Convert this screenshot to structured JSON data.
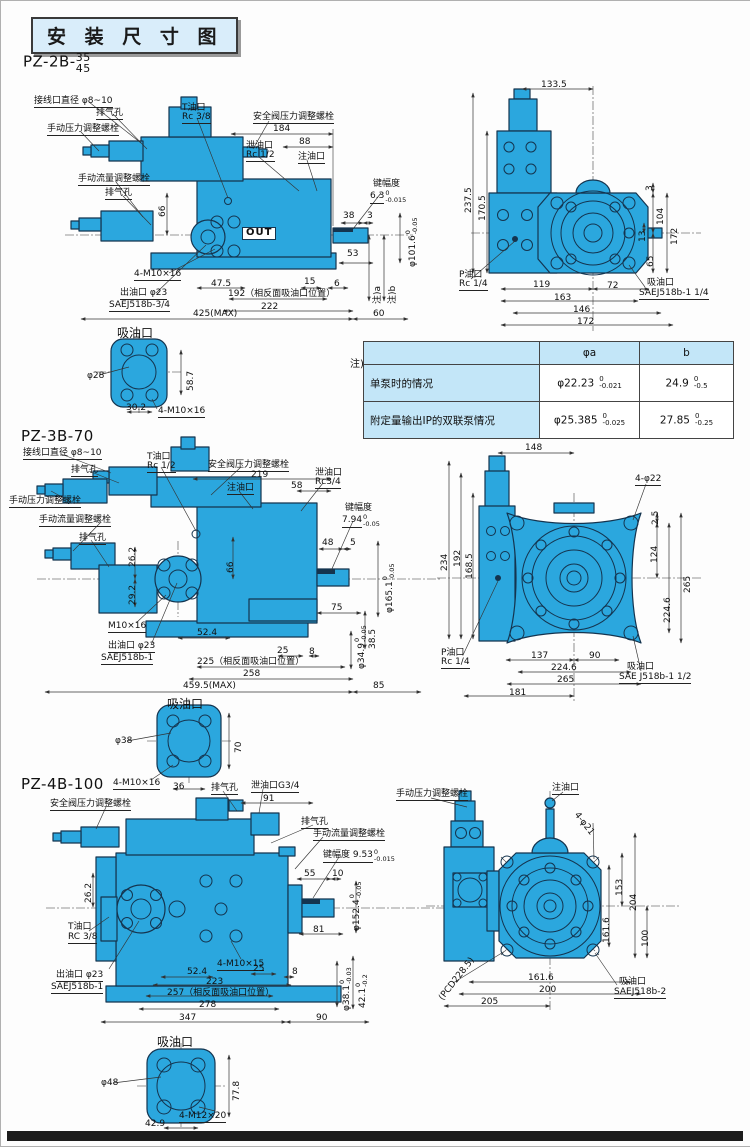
{
  "page": {
    "title": "安 装 尺 寸 图"
  },
  "note_table": {
    "note_label": "注)",
    "col_headers": [
      "φa",
      "b"
    ],
    "rows": [
      {
        "label": "单泵时的情况",
        "a_main": "φ22.23",
        "a_tol_top": "0",
        "a_tol_bot": "-0.021",
        "b_main": "24.9",
        "b_tol_top": "0",
        "b_tol_bot": "-0.5"
      },
      {
        "label": "附定量输出IP的双联泵情况",
        "a_main": "φ25.385",
        "a_tol_top": "0",
        "a_tol_bot": "-0.025",
        "b_main": "27.85",
        "b_tol_top": "0",
        "b_tol_bot": "-0.25"
      }
    ]
  },
  "sections": [
    {
      "name": "pz-2b",
      "model": "PZ-2B-",
      "frac_top": "35",
      "frac_bottom": "45",
      "labels": [
        {
          "t": "接线口直径 φ8~10",
          "x": 33,
          "y": 96,
          "u": 1
        },
        {
          "t": "排气孔",
          "x": 95,
          "y": 108,
          "u": 1
        },
        {
          "t": "T油口",
          "x": 181,
          "y": 103
        },
        {
          "t": "Rc 3/8",
          "x": 181,
          "y": 112,
          "u": 1
        },
        {
          "t": "安全阀压力调整螺栓",
          "x": 252,
          "y": 112,
          "u": 1
        },
        {
          "t": "手动压力调整螺栓",
          "x": 46,
          "y": 124,
          "u": 1
        },
        {
          "t": "184",
          "x": 272,
          "y": 124
        },
        {
          "t": "88",
          "x": 298,
          "y": 137
        },
        {
          "t": "泄油口",
          "x": 245,
          "y": 141
        },
        {
          "t": "Rc 1/2",
          "x": 245,
          "y": 150,
          "u": 1
        },
        {
          "t": "注油口",
          "x": 297,
          "y": 152,
          "u": 1
        },
        {
          "t": "手动流量调整螺栓",
          "x": 77,
          "y": 174,
          "u": 1
        },
        {
          "t": "排气孔",
          "x": 104,
          "y": 188,
          "u": 1
        },
        {
          "t": "66",
          "x": 158,
          "y": 216,
          "r": -90
        },
        {
          "t": "键幅度",
          "x": 372,
          "y": 179
        },
        {
          "t": "6.3",
          "x": 369,
          "y": 189,
          "tt": "0",
          "tb": "-0.015",
          "u": 1
        },
        {
          "t": "38",
          "x": 342,
          "y": 211
        },
        {
          "t": "3",
          "x": 366,
          "y": 211
        },
        {
          "t": "53",
          "x": 346,
          "y": 249
        },
        {
          "t": "φ101.6",
          "x": 404,
          "y": 266,
          "r": -90,
          "tt": "0",
          "tb": "-0.05"
        },
        {
          "t": "6",
          "x": 333,
          "y": 279
        },
        {
          "t": "注)a",
          "x": 373,
          "y": 303,
          "r": -90
        },
        {
          "t": "注)b",
          "x": 388,
          "y": 303,
          "r": -90
        },
        {
          "t": "OUT",
          "x": 241,
          "y": 226,
          "bx": 1
        },
        {
          "t": "4-M10×16",
          "x": 133,
          "y": 269,
          "u": 1
        },
        {
          "t": "47.5",
          "x": 210,
          "y": 279
        },
        {
          "t": "15",
          "x": 303,
          "y": 277
        },
        {
          "t": "出油口 φ23",
          "x": 119,
          "y": 288,
          "u": 1
        },
        {
          "t": "SAEJ518b-3/4",
          "x": 108,
          "y": 300,
          "u": 1
        },
        {
          "t": "192（相反面吸油口位置）",
          "x": 227,
          "y": 289
        },
        {
          "t": "222",
          "x": 260,
          "y": 302
        },
        {
          "t": "425(MAX)",
          "x": 192,
          "y": 309
        },
        {
          "t": "60",
          "x": 372,
          "y": 309
        },
        {
          "t": "133.5",
          "x": 540,
          "y": 80
        },
        {
          "t": "237.5",
          "x": 464,
          "y": 212,
          "r": -90
        },
        {
          "t": "170.5",
          "x": 478,
          "y": 220,
          "r": -90
        },
        {
          "t": "3",
          "x": 645,
          "y": 190,
          "r": -90
        },
        {
          "t": "104",
          "x": 656,
          "y": 224,
          "r": -90
        },
        {
          "t": "13",
          "x": 638,
          "y": 241,
          "r": -90
        },
        {
          "t": "172",
          "x": 670,
          "y": 244,
          "r": -90
        },
        {
          "t": "65",
          "x": 646,
          "y": 266,
          "r": -90
        },
        {
          "t": "P油口",
          "x": 458,
          "y": 270
        },
        {
          "t": "Rc 1/4",
          "x": 458,
          "y": 279,
          "u": 1
        },
        {
          "t": "119",
          "x": 532,
          "y": 280
        },
        {
          "t": "163",
          "x": 553,
          "y": 293
        },
        {
          "t": "72",
          "x": 606,
          "y": 281
        },
        {
          "t": "146",
          "x": 572,
          "y": 305
        },
        {
          "t": "172",
          "x": 576,
          "y": 317
        },
        {
          "t": "吸油口",
          "x": 646,
          "y": 278
        },
        {
          "t": "SAEJ518b-1 1/4",
          "x": 638,
          "y": 288,
          "u": 1
        },
        {
          "t": "吸油口",
          "x": 116,
          "y": 326,
          "fs": 12
        },
        {
          "t": "φ28",
          "x": 86,
          "y": 371
        },
        {
          "t": "58.7",
          "x": 186,
          "y": 390,
          "r": -90
        },
        {
          "t": "30.2",
          "x": 125,
          "y": 403
        },
        {
          "t": "4-M10×16",
          "x": 157,
          "y": 406,
          "u": 1
        }
      ]
    },
    {
      "name": "pz-3b",
      "model": "PZ-3B-70",
      "labels": [
        {
          "t": "接线口直径 φ8~10",
          "x": 22,
          "y": 448,
          "u": 1
        },
        {
          "t": "排气孔",
          "x": 70,
          "y": 465,
          "u": 1
        },
        {
          "t": "T油口",
          "x": 146,
          "y": 452
        },
        {
          "t": "Rc 1/2",
          "x": 146,
          "y": 461,
          "u": 1
        },
        {
          "t": "安全阀压力调整螺栓",
          "x": 207,
          "y": 460,
          "u": 1
        },
        {
          "t": "219",
          "x": 250,
          "y": 470
        },
        {
          "t": "注油口",
          "x": 226,
          "y": 483,
          "u": 1
        },
        {
          "t": "58",
          "x": 290,
          "y": 481
        },
        {
          "t": "泄油口",
          "x": 314,
          "y": 468
        },
        {
          "t": "Rc3/4",
          "x": 314,
          "y": 477,
          "u": 1
        },
        {
          "t": "手动压力调整螺栓",
          "x": 8,
          "y": 496,
          "u": 1
        },
        {
          "t": "手动流量调整螺栓",
          "x": 38,
          "y": 515,
          "u": 1
        },
        {
          "t": "排气孔",
          "x": 78,
          "y": 533,
          "u": 1
        },
        {
          "t": "26.2",
          "x": 128,
          "y": 566,
          "r": -90
        },
        {
          "t": "键幅度",
          "x": 344,
          "y": 503
        },
        {
          "t": "7.94",
          "x": 341,
          "y": 513,
          "tt": "0",
          "tb": "-0.05",
          "u": 1
        },
        {
          "t": "48",
          "x": 321,
          "y": 538
        },
        {
          "t": "5",
          "x": 349,
          "y": 538
        },
        {
          "t": "66",
          "x": 226,
          "y": 572,
          "r": -90
        },
        {
          "t": "29.2",
          "x": 128,
          "y": 604,
          "r": -90
        },
        {
          "t": "φ165.1",
          "x": 381,
          "y": 612,
          "r": -90,
          "tt": "0",
          "tb": "-0.05"
        },
        {
          "t": "75",
          "x": 330,
          "y": 603
        },
        {
          "t": "M10×16",
          "x": 107,
          "y": 621,
          "u": 1
        },
        {
          "t": "52.4",
          "x": 196,
          "y": 628
        },
        {
          "t": "38.5",
          "x": 368,
          "y": 648,
          "r": -90
        },
        {
          "t": "φ34.9",
          "x": 353,
          "y": 668,
          "r": -90,
          "tt": "0",
          "tb": "-0.05"
        },
        {
          "t": "出油口 φ23",
          "x": 107,
          "y": 641,
          "u": 1
        },
        {
          "t": "SAEJ518b-1",
          "x": 100,
          "y": 653,
          "u": 1
        },
        {
          "t": "25",
          "x": 276,
          "y": 646
        },
        {
          "t": "8",
          "x": 308,
          "y": 647
        },
        {
          "t": "225（相反面吸油口位置）",
          "x": 196,
          "y": 657
        },
        {
          "t": "258",
          "x": 242,
          "y": 669
        },
        {
          "t": "459.5(MAX)",
          "x": 182,
          "y": 681
        },
        {
          "t": "85",
          "x": 372,
          "y": 681
        },
        {
          "t": "吸油口",
          "x": 166,
          "y": 697,
          "fs": 12
        },
        {
          "t": "148",
          "x": 524,
          "y": 443
        },
        {
          "t": "4-φ22",
          "x": 634,
          "y": 474,
          "u": 1
        },
        {
          "t": "2.5",
          "x": 651,
          "y": 524,
          "r": -90
        },
        {
          "t": "234",
          "x": 440,
          "y": 570,
          "r": -90
        },
        {
          "t": "192",
          "x": 453,
          "y": 566,
          "r": -90
        },
        {
          "t": "168.5",
          "x": 465,
          "y": 578,
          "r": -90
        },
        {
          "t": "124",
          "x": 650,
          "y": 562,
          "r": -90
        },
        {
          "t": "265",
          "x": 683,
          "y": 592,
          "r": -90
        },
        {
          "t": "224.6",
          "x": 663,
          "y": 622,
          "r": -90
        },
        {
          "t": "P油口",
          "x": 440,
          "y": 648
        },
        {
          "t": "Rc 1/4",
          "x": 440,
          "y": 657,
          "u": 1
        },
        {
          "t": "137",
          "x": 530,
          "y": 651
        },
        {
          "t": "90",
          "x": 588,
          "y": 651
        },
        {
          "t": "224.6",
          "x": 550,
          "y": 663
        },
        {
          "t": "265",
          "x": 556,
          "y": 675
        },
        {
          "t": "181",
          "x": 508,
          "y": 688
        },
        {
          "t": "吸油口",
          "x": 626,
          "y": 662
        },
        {
          "t": "SAE J518b-1 1/2",
          "x": 618,
          "y": 672,
          "u": 1
        },
        {
          "t": "φ38",
          "x": 114,
          "y": 736
        },
        {
          "t": "70",
          "x": 234,
          "y": 752,
          "r": -90
        },
        {
          "t": "4-M10×16",
          "x": 112,
          "y": 778,
          "u": 1
        },
        {
          "t": "36",
          "x": 172,
          "y": 782
        }
      ]
    },
    {
      "name": "pz-4b",
      "model": "PZ-4B-100",
      "labels": [
        {
          "t": "安全阀压力调整螺栓",
          "x": 49,
          "y": 799,
          "u": 1
        },
        {
          "t": "排气孔",
          "x": 210,
          "y": 783,
          "u": 1
        },
        {
          "t": "泄油口G3/4",
          "x": 250,
          "y": 781,
          "u": 1
        },
        {
          "t": "91",
          "x": 262,
          "y": 794
        },
        {
          "t": "排气孔",
          "x": 300,
          "y": 817,
          "u": 1
        },
        {
          "t": "手动压力调整螺栓",
          "x": 395,
          "y": 789,
          "u": 1
        },
        {
          "t": "注油口",
          "x": 551,
          "y": 783,
          "u": 1
        },
        {
          "t": "手动流量调整螺栓",
          "x": 312,
          "y": 829,
          "u": 1
        },
        {
          "t": "键幅度 9.53",
          "x": 322,
          "y": 848,
          "tt": "0",
          "tb": "-0.015",
          "u": 1
        },
        {
          "t": "26.2",
          "x": 84,
          "y": 902,
          "r": -90
        },
        {
          "t": "55",
          "x": 303,
          "y": 869
        },
        {
          "t": "10",
          "x": 331,
          "y": 869
        },
        {
          "t": "4-φ21",
          "x": 578,
          "y": 810,
          "r": 52
        },
        {
          "t": "153",
          "x": 615,
          "y": 895,
          "r": -90
        },
        {
          "t": "204",
          "x": 629,
          "y": 910,
          "r": -90
        },
        {
          "t": "φ152.4",
          "x": 348,
          "y": 930,
          "r": -90,
          "tt": "0",
          "tb": "-0.05"
        },
        {
          "t": "T油口",
          "x": 67,
          "y": 922
        },
        {
          "t": "RC 3/8",
          "x": 67,
          "y": 932,
          "u": 1
        },
        {
          "t": "81",
          "x": 312,
          "y": 925
        },
        {
          "t": "161.6",
          "x": 602,
          "y": 942,
          "r": -90
        },
        {
          "t": "100",
          "x": 641,
          "y": 946,
          "r": -90
        },
        {
          "t": "出油口 φ23",
          "x": 55,
          "y": 970,
          "u": 1
        },
        {
          "t": "SAEJ518b-1",
          "x": 50,
          "y": 982,
          "u": 1
        },
        {
          "t": "4-M10×15",
          "x": 216,
          "y": 959,
          "u": 1
        },
        {
          "t": "52.4",
          "x": 186,
          "y": 967
        },
        {
          "t": "25",
          "x": 252,
          "y": 964
        },
        {
          "t": "8",
          "x": 291,
          "y": 967
        },
        {
          "t": "φ38.1",
          "x": 338,
          "y": 1010,
          "r": -90,
          "tt": "0",
          "tb": "-0.03"
        },
        {
          "t": "42.1",
          "x": 354,
          "y": 1007,
          "r": -90,
          "tt": "0",
          "tb": "-0.2"
        },
        {
          "t": "223",
          "x": 205,
          "y": 977
        },
        {
          "t": "257（相反面吸油口位置）",
          "x": 166,
          "y": 988
        },
        {
          "t": "278",
          "x": 198,
          "y": 1000
        },
        {
          "t": "347",
          "x": 178,
          "y": 1013
        },
        {
          "t": "90",
          "x": 315,
          "y": 1013
        },
        {
          "t": "(PCD228.5)",
          "x": 437,
          "y": 996,
          "r": -52
        },
        {
          "t": "161.6",
          "x": 527,
          "y": 973
        },
        {
          "t": "200",
          "x": 538,
          "y": 985
        },
        {
          "t": "205",
          "x": 480,
          "y": 997
        },
        {
          "t": "吸油口",
          "x": 618,
          "y": 977
        },
        {
          "t": "SAEJ518b-2",
          "x": 613,
          "y": 987,
          "u": 1
        },
        {
          "t": "吸油口",
          "x": 156,
          "y": 1035,
          "fs": 12
        },
        {
          "t": "φ48",
          "x": 100,
          "y": 1078
        },
        {
          "t": "77.8",
          "x": 232,
          "y": 1100,
          "r": -90
        },
        {
          "t": "4-M12×20",
          "x": 178,
          "y": 1111,
          "u": 1
        },
        {
          "t": "42.9",
          "x": 144,
          "y": 1119
        }
      ]
    }
  ]
}
